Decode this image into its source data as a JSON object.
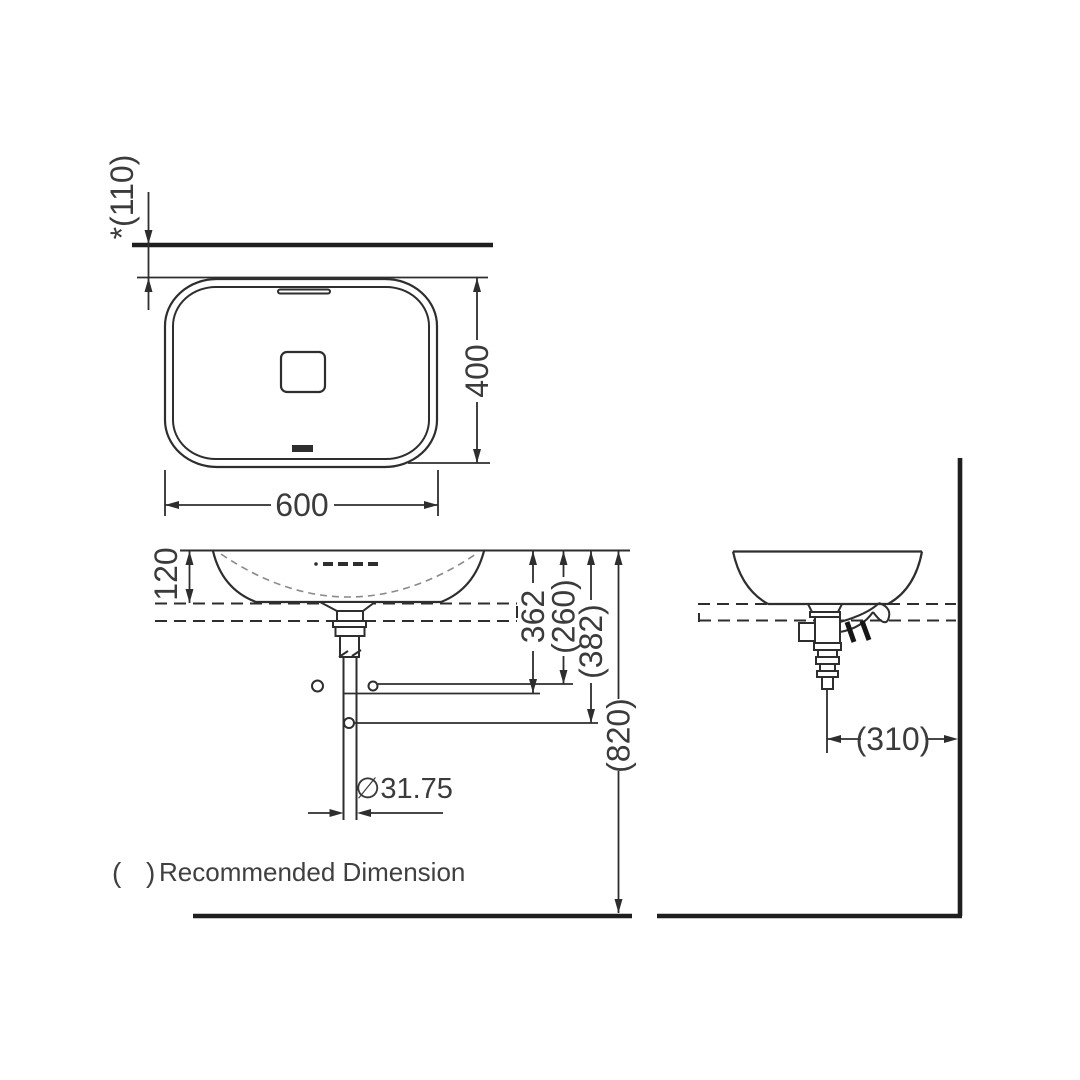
{
  "top_view": {
    "wall_offset": "*(110)",
    "depth": "400",
    "width": "600"
  },
  "front_view": {
    "bowl_height": "120",
    "drain_depth": "362",
    "rec_drain_depth": "(260)",
    "rec_outlet_depth": "(382)",
    "rec_counter_height": "(820)",
    "pipe_diameter": "∅31.75"
  },
  "side_view": {
    "drain_to_wall": "(310)"
  },
  "legend": {
    "paren_open": "(",
    "paren_close": ")",
    "label": "Recommended Dimension"
  },
  "colors": {
    "line": "#2e2e2e",
    "text": "#3b3b3b",
    "background": "#ffffff"
  }
}
